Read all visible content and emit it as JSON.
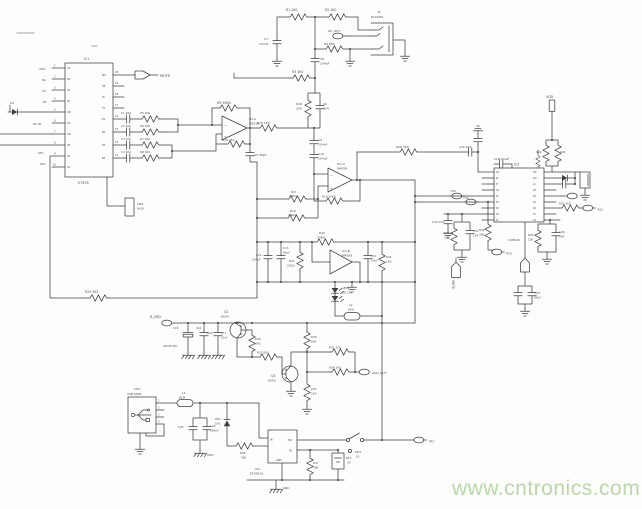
{
  "canvas": {
    "width": 642,
    "height": 509,
    "background": "#fdfdfb",
    "line_color": "#3f3f3f",
    "label_color": "#4c4c4c"
  },
  "watermark": {
    "text": "www.cntronics.com",
    "color": "#b9d8a9"
  },
  "parts": {
    "main_ic": "IC1 E7505",
    "audio_jack": "J1 PJ-302M",
    "usb_connector": "CN1 USB MDR",
    "dcdc_ic": "IC2 ET4001A",
    "right_ic": "IC3 CS8645",
    "opamps": [
      "U2-A M5218",
      "IC1-A M4558",
      "IC1-B M4558"
    ],
    "transistors": [
      "Q1 8550",
      "Q2 8050"
    ],
    "net_flags": [
      "MUTE",
      "AU_OUT",
      "AUD_OUT",
      "B_VDD",
      "VDD",
      "GND",
      "VO",
      "P20",
      "Y00",
      "Y01",
      "V02"
    ]
  },
  "labels": [
    {
      "t": "IC1",
      "x": 84,
      "y": 60,
      "s": 3.2
    },
    {
      "t": "E7505",
      "x": 78,
      "y": 184
    },
    {
      "t": "MUTE",
      "x": 160,
      "y": 77,
      "s": 3.6
    },
    {
      "t": "1",
      "x": 54,
      "y": 66.5,
      "s": 2.6
    },
    {
      "t": "2",
      "x": 54,
      "y": 77.5,
      "s": 2.6
    },
    {
      "t": "3",
      "x": 54,
      "y": 88.5,
      "s": 2.6
    },
    {
      "t": "4",
      "x": 54,
      "y": 99.5,
      "s": 2.6
    },
    {
      "t": "5",
      "x": 54,
      "y": 110.5,
      "s": 2.6
    },
    {
      "t": "6",
      "x": 54,
      "y": 121.5,
      "s": 2.6
    },
    {
      "t": "7",
      "x": 54,
      "y": 132.5,
      "s": 2.6
    },
    {
      "t": "8",
      "x": 54,
      "y": 143.5,
      "s": 2.6
    },
    {
      "t": "9",
      "x": 54,
      "y": 154.5,
      "s": 2.6
    },
    {
      "t": "10",
      "x": 52.5,
      "y": 165.5,
      "s": 2.6
    },
    {
      "t": "20",
      "x": 115,
      "y": 73,
      "s": 2.6
    },
    {
      "t": "19",
      "x": 115,
      "y": 84,
      "s": 2.6
    },
    {
      "t": "18",
      "x": 115,
      "y": 95,
      "s": 2.6
    },
    {
      "t": "17",
      "x": 115,
      "y": 106,
      "s": 2.6
    },
    {
      "t": "16",
      "x": 115,
      "y": 117,
      "s": 2.6
    },
    {
      "t": "15",
      "x": 115,
      "y": 130,
      "s": 2.6
    },
    {
      "t": "14",
      "x": 115,
      "y": 143,
      "s": 2.6
    },
    {
      "t": "13",
      "x": 115,
      "y": 156,
      "s": 2.6
    },
    {
      "t": "VDD",
      "x": 39,
      "y": 70,
      "s": 2.8
    },
    {
      "t": "NC",
      "x": 42,
      "y": 81,
      "s": 2.8
    },
    {
      "t": "CP",
      "x": 42,
      "y": 92,
      "s": 2.8
    },
    {
      "t": "IN",
      "x": 43,
      "y": 103,
      "s": 2.8
    },
    {
      "t": "DC IN",
      "x": 33,
      "y": 125,
      "s": 2.8
    },
    {
      "t": "LED",
      "x": 38,
      "y": 154,
      "s": 2.8
    },
    {
      "t": "LED",
      "x": 40,
      "y": 165,
      "s": 2.8
    },
    {
      "t": "D1",
      "x": 10,
      "y": 104,
      "s": 3
    },
    {
      "t": "VD",
      "x": 67,
      "y": 69,
      "s": 2.4
    },
    {
      "t": "NC",
      "x": 67,
      "y": 80,
      "s": 2.4
    },
    {
      "t": "CP",
      "x": 67,
      "y": 91,
      "s": 2.4
    },
    {
      "t": "IN",
      "x": 67,
      "y": 102,
      "s": 2.4
    },
    {
      "t": "UN",
      "x": 67,
      "y": 113,
      "s": 2.4
    },
    {
      "t": "DC",
      "x": 67,
      "y": 124,
      "s": 2.4
    },
    {
      "t": "GN",
      "x": 67,
      "y": 135,
      "s": 2.4
    },
    {
      "t": "VR",
      "x": 67,
      "y": 146,
      "s": 2.4
    },
    {
      "t": "LD",
      "x": 67,
      "y": 157,
      "s": 2.4
    },
    {
      "t": "LD",
      "x": 67,
      "y": 168,
      "s": 2.4
    },
    {
      "t": "MU",
      "x": 102,
      "y": 76,
      "s": 2.4
    },
    {
      "t": "HP",
      "x": 102,
      "y": 87,
      "s": 2.4
    },
    {
      "t": "ID",
      "x": 102,
      "y": 98,
      "s": 2.4
    },
    {
      "t": "TS",
      "x": 102,
      "y": 109,
      "s": 2.4
    },
    {
      "t": "B1",
      "x": 102,
      "y": 120,
      "s": 2.4
    },
    {
      "t": "B2",
      "x": 102,
      "y": 133,
      "s": 2.4
    },
    {
      "t": "B3",
      "x": 102,
      "y": 146,
      "s": 2.4
    },
    {
      "t": "B4",
      "x": 102,
      "y": 159,
      "s": 2.4
    },
    {
      "t": "C1 104",
      "x": 121,
      "y": 114,
      "s": 2.8
    },
    {
      "t": "C2 104",
      "x": 121,
      "y": 127,
      "s": 2.8
    },
    {
      "t": "C3 104",
      "x": 121,
      "y": 140,
      "s": 2.8
    },
    {
      "t": "C4 104",
      "x": 121,
      "y": 153,
      "s": 2.8
    },
    {
      "t": "R5 1K0",
      "x": 140,
      "y": 114,
      "s": 2.8
    },
    {
      "t": "R6 1K0",
      "x": 140,
      "y": 127,
      "s": 2.8
    },
    {
      "t": "R7 1K0",
      "x": 140,
      "y": 140,
      "s": 2.8
    },
    {
      "t": "R8 1K0",
      "x": 140,
      "y": 153,
      "s": 2.8
    },
    {
      "t": "CN2",
      "x": 137,
      "y": 205,
      "s": 3
    },
    {
      "t": "W20",
      "x": 137,
      "y": 209.5,
      "s": 3
    },
    {
      "t": "R9 10KΩ",
      "x": 217,
      "y": 104,
      "s": 3.2
    },
    {
      "t": "U2-A",
      "x": 249,
      "y": 120,
      "s": 3
    },
    {
      "t": "M5218",
      "x": 249,
      "y": 124.5,
      "s": 3
    },
    {
      "t": "−",
      "x": 224,
      "y": 127,
      "s": 3.4
    },
    {
      "t": "+",
      "x": 224,
      "y": 138,
      "s": 3.4
    },
    {
      "t": "R10 2K2",
      "x": 222,
      "y": 141,
      "s": 3
    },
    {
      "t": "C5 43pF",
      "x": 254,
      "y": 156,
      "s": 3
    },
    {
      "t": "R15 1K0",
      "x": 257,
      "y": 124,
      "s": 3
    },
    {
      "t": "R1 1K0",
      "x": 286,
      "y": 11,
      "s": 3.2
    },
    {
      "t": "R2 1K0",
      "x": 325,
      "y": 11,
      "s": 3.2
    },
    {
      "t": "C7",
      "x": 264,
      "y": 40,
      "s": 3
    },
    {
      "t": "104uF",
      "x": 259,
      "y": 45,
      "s": 3
    },
    {
      "t": "AU_OUT",
      "x": 328,
      "y": 32,
      "s": 3
    },
    {
      "t": "R4 680",
      "x": 324,
      "y": 45,
      "s": 3
    },
    {
      "t": "C8",
      "x": 320,
      "y": 60,
      "s": 3
    },
    {
      "t": "104uF",
      "x": 320,
      "y": 64.5,
      "s": 3
    },
    {
      "t": "R3 4K0",
      "x": 292,
      "y": 73,
      "s": 3.2
    },
    {
      "t": "J1",
      "x": 378,
      "y": 13,
      "s": 3
    },
    {
      "t": "PJ-302M",
      "x": 371,
      "y": 18,
      "s": 3
    },
    {
      "t": "R16",
      "x": 296,
      "y": 105,
      "s": 3
    },
    {
      "t": "20K",
      "x": 296,
      "y": 109.5,
      "s": 3
    },
    {
      "t": "C6",
      "x": 323,
      "y": 105,
      "s": 3
    },
    {
      "t": "104",
      "x": 323,
      "y": 109.5,
      "s": 3
    },
    {
      "t": "C9",
      "x": 318,
      "y": 141,
      "s": 3
    },
    {
      "t": "104uF",
      "x": 318,
      "y": 145.5,
      "s": 3
    },
    {
      "t": "C10",
      "x": 318,
      "y": 155,
      "s": 3
    },
    {
      "t": "104uF",
      "x": 318,
      "y": 159.5,
      "s": 3
    },
    {
      "t": "IC1-A",
      "x": 337,
      "y": 165,
      "s": 3
    },
    {
      "t": "M4558",
      "x": 337,
      "y": 169.5,
      "s": 3
    },
    {
      "t": "−",
      "x": 330,
      "y": 177,
      "s": 3.4
    },
    {
      "t": "+",
      "x": 330,
      "y": 190,
      "s": 3.4
    },
    {
      "t": "R17",
      "x": 291,
      "y": 193,
      "s": 2.8
    },
    {
      "t": "20KΩ",
      "x": 289,
      "y": 197,
      "s": 2.8
    },
    {
      "t": "R18",
      "x": 290,
      "y": 212,
      "s": 2.8
    },
    {
      "t": "30KΩ",
      "x": 288,
      "y": 216,
      "s": 2.8
    },
    {
      "t": "R19 10KΩ",
      "x": 322,
      "y": 197.5,
      "s": 2.8
    },
    {
      "t": "R20",
      "x": 319,
      "y": 234,
      "s": 3
    },
    {
      "t": "24KΩ",
      "x": 317,
      "y": 238.5,
      "s": 3
    },
    {
      "t": "C12",
      "x": 256,
      "y": 256,
      "s": 2.8
    },
    {
      "t": "104uF",
      "x": 252,
      "y": 260.5,
      "s": 2.8
    },
    {
      "t": "C13",
      "x": 283,
      "y": 249,
      "s": 2.8
    },
    {
      "t": "60uF",
      "x": 283,
      "y": 253.5,
      "s": 2.8
    },
    {
      "t": "R21",
      "x": 289,
      "y": 262,
      "s": 2.8
    },
    {
      "t": "22KΩ",
      "x": 287,
      "y": 266.5,
      "s": 2.8
    },
    {
      "t": "IC1-B",
      "x": 342,
      "y": 252,
      "s": 3
    },
    {
      "t": "M4558",
      "x": 342,
      "y": 256.5,
      "s": 3
    },
    {
      "t": "C11",
      "x": 371,
      "y": 257,
      "s": 2.8
    },
    {
      "t": "10uF",
      "x": 371,
      "y": 261.5,
      "s": 2.8
    },
    {
      "t": "R22",
      "x": 386,
      "y": 258,
      "s": 2.8
    },
    {
      "t": "1K0",
      "x": 386,
      "y": 262.5,
      "s": 2.8
    },
    {
      "t": "LED1",
      "x": 342,
      "y": 289,
      "s": 3
    },
    {
      "t": "LD 5/8",
      "x": 342,
      "y": 293.5,
      "s": 3
    },
    {
      "t": "L2",
      "x": 349,
      "y": 306,
      "s": 3
    },
    {
      "t": "600",
      "x": 348,
      "y": 310.5,
      "s": 3
    },
    {
      "t": "R23 3K2",
      "x": 85,
      "y": 293,
      "s": 3.2
    },
    {
      "t": "B_VDD",
      "x": 150,
      "y": 318,
      "s": 3.2
    },
    {
      "t": "C15",
      "x": 173,
      "y": 329,
      "s": 2.8
    },
    {
      "t": "220UF/16V",
      "x": 163,
      "y": 347,
      "s": 2.6
    },
    {
      "t": "C16",
      "x": 196,
      "y": 329,
      "s": 2.6
    },
    {
      "t": "10uF",
      "x": 206.5,
      "y": 334,
      "s": 2.6
    },
    {
      "t": "C17",
      "x": 221,
      "y": 334,
      "s": 2.6
    },
    {
      "t": "10uF",
      "x": 221,
      "y": 338.5,
      "s": 2.6
    },
    {
      "t": "Q1",
      "x": 224,
      "y": 313,
      "s": 3.2
    },
    {
      "t": "8550",
      "x": 221,
      "y": 317.5,
      "s": 3
    },
    {
      "t": "R26",
      "x": 255,
      "y": 340,
      "s": 2.8
    },
    {
      "t": "2K0",
      "x": 255,
      "y": 344.5,
      "s": 2.8
    },
    {
      "t": "R27 600",
      "x": 257,
      "y": 353.5,
      "s": 2.8
    },
    {
      "t": "Q2",
      "x": 271,
      "y": 377,
      "s": 3.2
    },
    {
      "t": "8050",
      "x": 268,
      "y": 381.5,
      "s": 3
    },
    {
      "t": "R29",
      "x": 311,
      "y": 338,
      "s": 2.8
    },
    {
      "t": "600",
      "x": 311,
      "y": 342.5,
      "s": 2.8
    },
    {
      "t": "R31 350",
      "x": 329,
      "y": 348.5,
      "s": 2.8
    },
    {
      "t": "R34 1K0",
      "x": 329,
      "y": 368.5,
      "s": 2.8
    },
    {
      "t": "R33",
      "x": 311,
      "y": 390,
      "s": 2.8
    },
    {
      "t": "1K0",
      "x": 311,
      "y": 394.5,
      "s": 2.8
    },
    {
      "t": "AUD_OUT",
      "x": 372,
      "y": 374,
      "s": 3
    },
    {
      "t": "CN1",
      "x": 134,
      "y": 390,
      "s": 3
    },
    {
      "t": "USB MDR",
      "x": 127,
      "y": 395,
      "s": 3
    },
    {
      "t": "1",
      "x": 158,
      "y": 401.5,
      "s": 2.4
    },
    {
      "t": "2",
      "x": 158,
      "y": 408.5,
      "s": 2.4
    },
    {
      "t": "3",
      "x": 158,
      "y": 415.5,
      "s": 2.4
    },
    {
      "t": "4",
      "x": 158,
      "y": 422.5,
      "s": 2.4
    },
    {
      "t": "L1",
      "x": 182,
      "y": 394,
      "s": 3
    },
    {
      "t": "BLM",
      "x": 179,
      "y": 398.5,
      "s": 3
    },
    {
      "t": "C25",
      "x": 178,
      "y": 428,
      "s": 2.8
    },
    {
      "t": "C24",
      "x": 210,
      "y": 427,
      "s": 2.8
    },
    {
      "t": "104uF",
      "x": 210,
      "y": 431.5,
      "s": 2.8
    },
    {
      "t": "VDD",
      "x": 207,
      "y": 456,
      "s": 3
    },
    {
      "t": "ZD1",
      "x": 215,
      "y": 420,
      "s": 2.8
    },
    {
      "t": "5V1",
      "x": 215,
      "y": 424.5,
      "s": 2.8
    },
    {
      "t": "R36",
      "x": 240,
      "y": 454,
      "s": 2.8
    },
    {
      "t": "450",
      "x": 241,
      "y": 458.5,
      "s": 2.8
    },
    {
      "t": "IC2",
      "x": 255,
      "y": 470,
      "s": 3
    },
    {
      "t": "ET4001A",
      "x": 250,
      "y": 474.5,
      "s": 3
    },
    {
      "t": "IN",
      "x": 270,
      "y": 440.5,
      "s": 2.4
    },
    {
      "t": "SW",
      "x": 288,
      "y": 441,
      "s": 2.4
    },
    {
      "t": "FB",
      "x": 289,
      "y": 451.5,
      "s": 2.4
    },
    {
      "t": "GND",
      "x": 276,
      "y": 461,
      "s": 2.4
    },
    {
      "t": "R37",
      "x": 313,
      "y": 464,
      "s": 2.8
    },
    {
      "t": "300",
      "x": 313,
      "y": 468.5,
      "s": 2.8
    },
    {
      "t": "BT1",
      "x": 346,
      "y": 459,
      "s": 2.8
    },
    {
      "t": "3V",
      "x": 347,
      "y": 463.5,
      "s": 2.8
    },
    {
      "t": "SW1",
      "x": 355,
      "y": 453,
      "s": 2.8
    },
    {
      "t": "K1",
      "x": 356,
      "y": 457.5,
      "s": 2.8
    },
    {
      "t": "VO",
      "x": 429,
      "y": 442.5,
      "s": 3.2
    },
    {
      "t": "GND",
      "x": 283,
      "y": 489,
      "s": 2.8
    },
    {
      "t": "Y00",
      "x": 450,
      "y": 192,
      "s": 3
    },
    {
      "t": "Y01",
      "x": 463,
      "y": 199,
      "s": 3
    },
    {
      "t": "C20 104",
      "x": 432,
      "y": 223,
      "s": 2.8
    },
    {
      "t": "R30",
      "x": 444,
      "y": 234,
      "s": 2.8
    },
    {
      "t": "100",
      "x": 444,
      "y": 238.5,
      "s": 2.8
    },
    {
      "t": "C21",
      "x": 473,
      "y": 232,
      "s": 2.8
    },
    {
      "t": "104",
      "x": 473,
      "y": 236.5,
      "s": 2.8
    },
    {
      "t": "MUTE",
      "x": 452,
      "y": 280,
      "s": 3.2,
      "r": 90
    },
    {
      "t": "R32",
      "x": 479,
      "y": 231,
      "s": 2.8
    },
    {
      "t": "300",
      "x": 479,
      "y": 235.5,
      "s": 2.8
    },
    {
      "t": "P20",
      "x": 506,
      "y": 254.5,
      "s": 3
    },
    {
      "t": "R28 3K0",
      "x": 396,
      "y": 148,
      "s": 3
    },
    {
      "t": "C19 104",
      "x": 459,
      "y": 148,
      "s": 2.8
    },
    {
      "t": "C18 104uF",
      "x": 494,
      "y": 160,
      "s": 2.8
    },
    {
      "t": "IC3",
      "x": 514,
      "y": 165.5,
      "s": 3.2
    },
    {
      "t": "CS8645",
      "x": 508,
      "y": 241,
      "s": 3
    },
    {
      "t": "VDD",
      "x": 546,
      "y": 98,
      "s": 3.2
    },
    {
      "t": "1K0",
      "x": 536,
      "y": 153,
      "s": 2.8
    },
    {
      "t": "1K0",
      "x": 560,
      "y": 153,
      "s": 2.8
    },
    {
      "t": "R25 1K0",
      "x": 559,
      "y": 204.5,
      "s": 2.8
    },
    {
      "t": "V02",
      "x": 597,
      "y": 210.5,
      "s": 3
    },
    {
      "t": "R24",
      "x": 528,
      "y": 236,
      "s": 2.8
    },
    {
      "t": "100",
      "x": 528,
      "y": 240.5,
      "s": 2.8
    },
    {
      "t": "C26",
      "x": 559,
      "y": 233,
      "s": 2.8
    },
    {
      "t": "104",
      "x": 559,
      "y": 237.5,
      "s": 2.8
    },
    {
      "t": "C27",
      "x": 535,
      "y": 294,
      "s": 2.8
    },
    {
      "t": "60uF",
      "x": 534,
      "y": 298.5,
      "s": 2.8
    },
    {
      "t": "AD",
      "x": 496,
      "y": 173,
      "s": 2.2
    },
    {
      "t": "IN",
      "x": 496,
      "y": 179,
      "s": 2.2
    },
    {
      "t": "IP",
      "x": 496,
      "y": 185,
      "s": 2.2
    },
    {
      "t": "LN",
      "x": 496,
      "y": 191,
      "s": 2.2
    },
    {
      "t": "KT",
      "x": 496,
      "y": 197,
      "s": 2.2
    },
    {
      "t": "PS",
      "x": 496,
      "y": 203,
      "s": 2.2
    },
    {
      "t": "PX",
      "x": 496,
      "y": 209,
      "s": 2.2
    },
    {
      "t": "RS",
      "x": 496,
      "y": 215,
      "s": 2.2
    },
    {
      "t": "SL",
      "x": 496,
      "y": 221,
      "s": 2.2
    },
    {
      "t": "SW",
      "x": 533,
      "y": 173,
      "s": 2.2
    },
    {
      "t": "SW",
      "x": 533,
      "y": 179,
      "s": 2.2
    },
    {
      "t": "LX",
      "x": 533,
      "y": 185,
      "s": 2.2
    },
    {
      "t": "VD",
      "x": 533,
      "y": 191,
      "s": 2.2
    },
    {
      "t": "D0",
      "x": 533,
      "y": 197,
      "s": 2.2
    },
    {
      "t": "D1",
      "x": 533,
      "y": 203,
      "s": 2.2
    },
    {
      "t": "RX",
      "x": 533,
      "y": 209,
      "s": 2.2
    },
    {
      "t": "TX",
      "x": 533,
      "y": 215,
      "s": 2.2
    },
    {
      "t": "VS",
      "x": 533,
      "y": 221,
      "s": 2.2
    }
  ]
}
